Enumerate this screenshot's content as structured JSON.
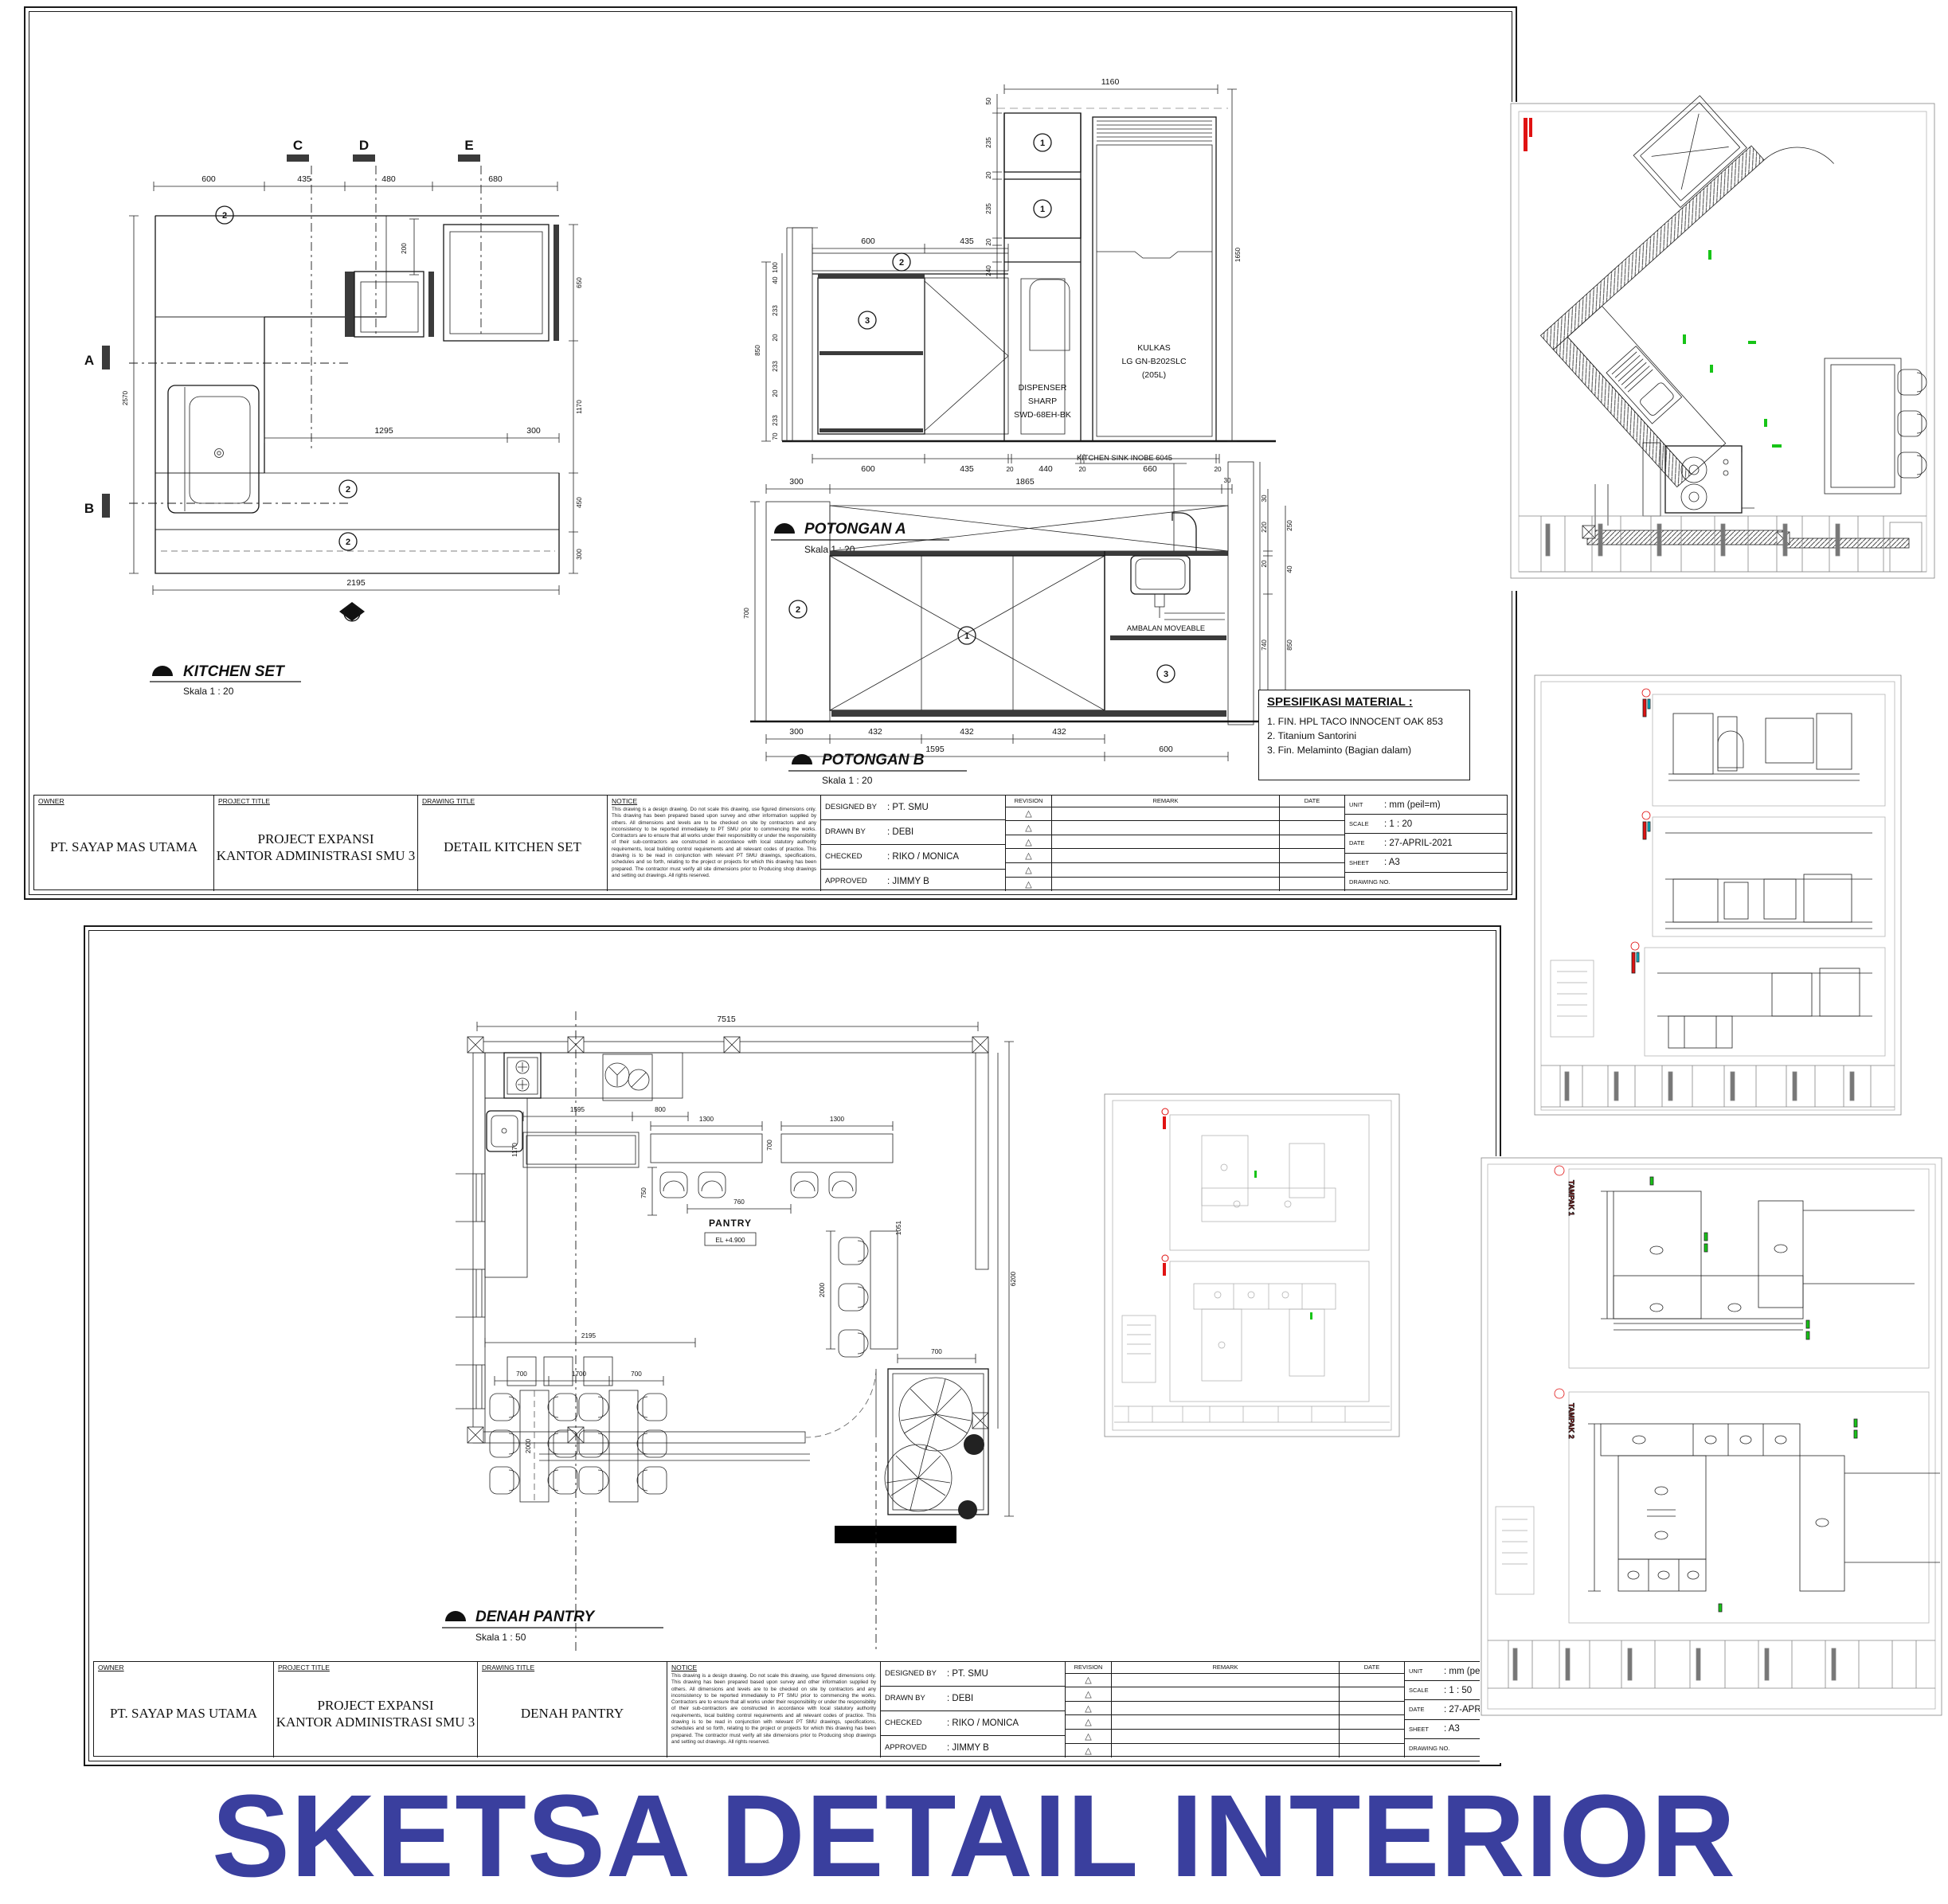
{
  "colors": {
    "banner": "#3a3f9e",
    "annotation_red": "#e01212",
    "annotation_green": "#17c417",
    "annotation_cyan": "#00b5cc",
    "highlight_blue": "#1d79e8"
  },
  "title_banner": {
    "text": "SKETSA DETAIL INTERIOR",
    "color": "#3a3f9e"
  },
  "keys": {
    "one": "1",
    "two": "2",
    "three": "3"
  },
  "icons": {
    "revision_triangle": "△"
  },
  "sheet1": {
    "kitchen_plan": {
      "title": "KITCHEN SET",
      "scale": "Skala 1 : 20",
      "markers": {
        "a": "A",
        "b": "B",
        "c": "C",
        "d": "D",
        "e": "E",
        "f": "F"
      },
      "dims": {
        "top": [
          "600",
          "435",
          "480",
          "680"
        ],
        "d200": "200",
        "left": "2570",
        "right": [
          "650",
          "1170",
          "450",
          "300"
        ],
        "mid": [
          "1295",
          "300"
        ],
        "bottom": "2195"
      }
    },
    "potongan_a": {
      "title": "POTONGAN A",
      "scale": "Skala 1 : 20",
      "dispenser": [
        "DISPENSER",
        "SHARP",
        "SWD-68EH-BK"
      ],
      "kulkas": [
        "KULKAS",
        "LG GN-B202SLC",
        "(205L)"
      ],
      "dims": {
        "top": "1160",
        "wall": [
          "50",
          "235",
          "20",
          "235",
          "20",
          "240"
        ],
        "counter": [
          "600",
          "435"
        ],
        "left": [
          "100",
          "40",
          "233",
          "20",
          "233",
          "20",
          "233",
          "70"
        ],
        "left_total": "850",
        "right": "1650",
        "bottom": [
          "600",
          "435",
          "20",
          "440",
          "20",
          "660",
          "20"
        ]
      }
    },
    "potongan_b": {
      "title": "POTONGAN B",
      "scale": "Skala 1 : 20",
      "sink_label": "KITCHEN SINK INOBE 6045",
      "ambalan_label": "AMBALAN MOVEABLE",
      "dims": {
        "top": [
          "300",
          "1865",
          "30"
        ],
        "right": [
          "30",
          "220",
          "20",
          "740",
          "50"
        ],
        "right_outer": [
          "250",
          "40",
          "850"
        ],
        "left": "700",
        "bottom1": [
          "300",
          "432",
          "432",
          "432"
        ],
        "bottom2": [
          "1595",
          "600"
        ]
      }
    },
    "spesifikasi": {
      "title": "SPESIFIKASI MATERIAL :",
      "items": [
        "1. FIN. HPL TACO INNOCENT OAK 853",
        "2. Titanium Santorini",
        "3. Fin. Melaminto (Bagian dalam)"
      ]
    },
    "titleblock": {
      "owner_label": "OWNER",
      "owner": "PT. SAYAP MAS UTAMA",
      "project_label": "PROJECT TITLE",
      "project_line1": "PROJECT EXPANSI",
      "project_line2": "KANTOR ADMINISTRASI SMU 3",
      "drawing_label": "DRAWING TITLE",
      "drawing_title": "DETAIL KITCHEN SET",
      "notice_label": "NOTICE",
      "notice": "This drawing is a design drawing. Do not scale this drawing, use figured dimensions only. This drawing has been prepared based upon survey and other information supplied by others. All dimensions and levels are to be checked on site by contractors and any inconsistency to be reported immediately to PT SMU prior to commencing the works. Contractors are to ensure that all works under their responsibility or under the responsibility of their sub-contractors are constructed in accordance with local statutory authority requirements, local building control requirements and all relevant codes of practice. This drawing is to be read in conjunction with relevant PT SMU drawings, specifications, schedules and so forth, relating to the project or projects for which this drawing has been prepared. The contractor must verify all site dimensions prior to Producing shop drawings and setting out drawings. All rights reserved.",
      "designed_label": "DESIGNED BY",
      "designed": ": PT. SMU",
      "drawn_label": "DRAWN BY",
      "drawn": ": DEBI",
      "checked_label": "CHECKED",
      "checked": ": RIKO / MONICA",
      "approved_label": "APPROVED",
      "approved": ": JIMMY B",
      "revision_label": "REVISION",
      "remark_label": "REMARK",
      "date_label": "DATE",
      "unit_label": "UNIT",
      "unit": ": mm (peil=m)",
      "scale_label": "SCALE",
      "scale": ": 1 : 20",
      "date2_label": "DATE",
      "date": ": 27-APRIL-2021",
      "sheet_label": "SHEET",
      "sheet": ": A3",
      "drawing_no_label": "DRAWING NO."
    }
  },
  "sheet2": {
    "denah_pantry": {
      "title": "DENAH PANTRY",
      "scale": "Skala 1 : 50",
      "room": "PANTRY",
      "level": "EL +4.900",
      "dims": {
        "top": "7515",
        "right": "6200",
        "counter": [
          "1595",
          "800"
        ],
        "island": "1170",
        "island_d": "750",
        "c2195": "2195",
        "tables": [
          "1300",
          "700",
          "1300",
          "760",
          "1051"
        ],
        "dining": [
          "700",
          "1700",
          "700"
        ],
        "table_len": "2000",
        "bench_len": "2000",
        "bench_w": "700"
      }
    },
    "titleblock": {
      "owner_label": "OWNER",
      "owner": "PT. SAYAP MAS UTAMA",
      "project_label": "PROJECT TITLE",
      "project_line1": "PROJECT EXPANSI",
      "project_line2": "KANTOR ADMINISTRASI SMU 3",
      "drawing_label": "DRAWING TITLE",
      "drawing_title": "DENAH PANTRY",
      "notice_label": "NOTICE",
      "notice": "This drawing is a design drawing. Do not scale this drawing, use figured dimensions only. This drawing has been prepared based upon survey and other information supplied by others. All dimensions and levels are to be checked on site by contractors and any inconsistency to be reported immediately to PT SMU prior to commencing the works. Contractors are to ensure that all works under their responsibility or under the responsibility of their sub-contractors are constructed in accordance with local statutory authority requirements, local building control requirements and all relevant codes of practice. This drawing is to be read in conjunction with relevant PT SMU drawings, specifications, schedules and so forth, relating to the project or projects for which this drawing has been prepared. The contractor must verify all site dimensions prior to Producing shop drawings and setting out drawings. All rights reserved.",
      "designed_label": "DESIGNED BY",
      "designed": ": PT. SMU",
      "drawn_label": "DRAWN BY",
      "drawn": ": DEBI",
      "checked_label": "CHECKED",
      "checked": ": RIKO / MONICA",
      "approved_label": "APPROVED",
      "approved": ": JIMMY B",
      "revision_label": "REVISION",
      "remark_label": "REMARK",
      "date_label": "DATE",
      "unit_label": "UNIT",
      "unit": ": mm (peil=m)",
      "scale_label": "SCALE",
      "scale": ": 1 : 50",
      "date2_label": "DATE",
      "date": ": 27-APRIL-2021",
      "sheet_label": "SHEET",
      "sheet": ": A3",
      "drawing_no_label": "DRAWING NO."
    }
  },
  "panels": {
    "tampak1": "TAMPAK 1",
    "tampak2": "TAMPAK 2"
  }
}
